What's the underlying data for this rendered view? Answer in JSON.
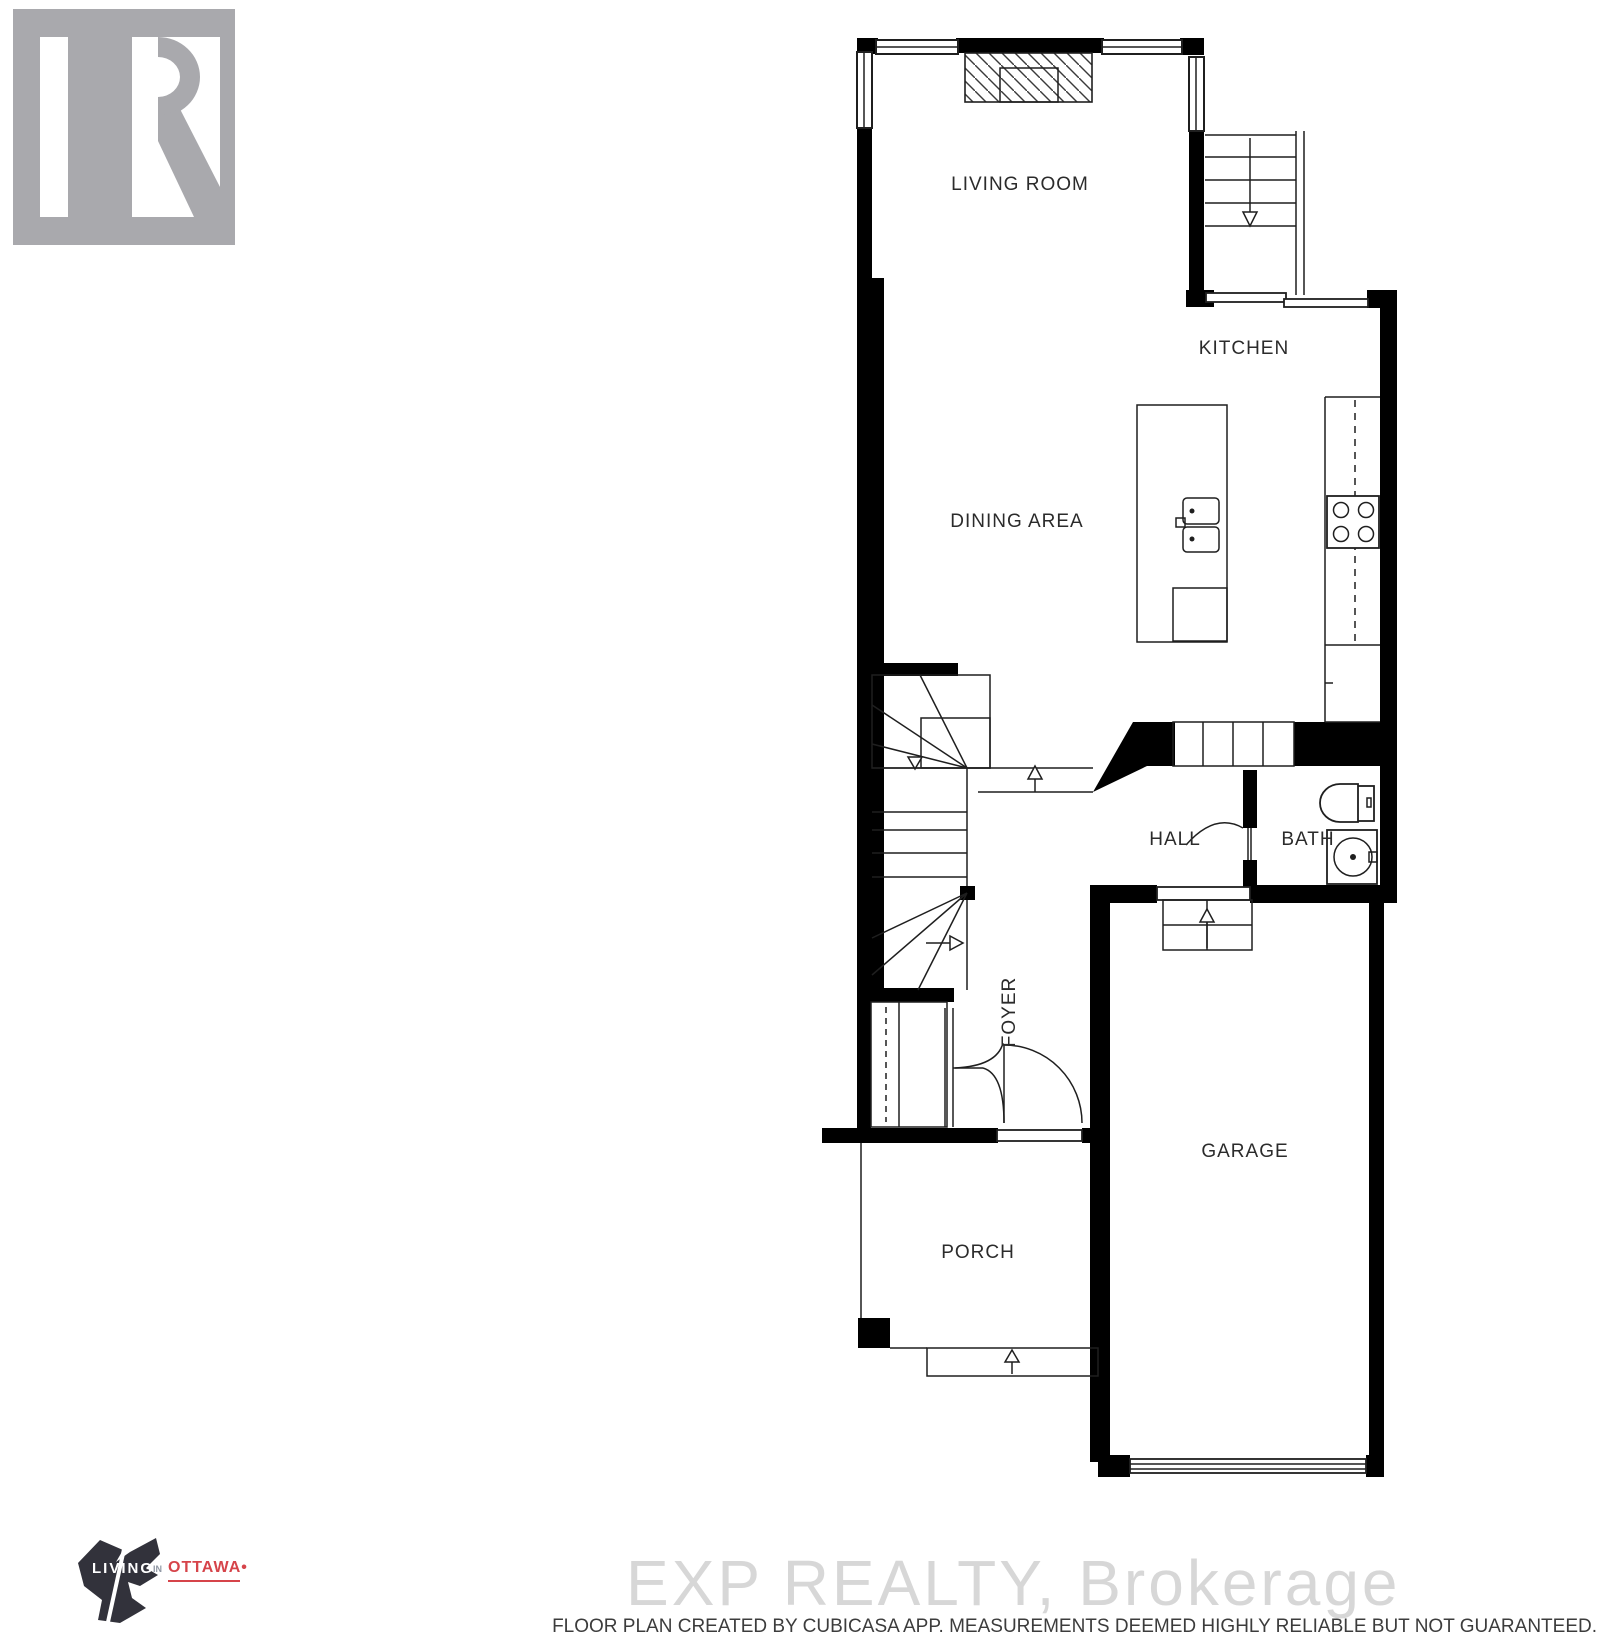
{
  "branding": {
    "realtor": {
      "name": "REALTOR",
      "mark": "®"
    },
    "living_in_ottawa": {
      "word1": "LIVING",
      "word2": "IN",
      "word3": "OTTAWA",
      "bullet": "•"
    }
  },
  "floor_plan": {
    "rooms": [
      {
        "id": "living-room",
        "label": "LIVING ROOM"
      },
      {
        "id": "kitchen",
        "label": "KITCHEN"
      },
      {
        "id": "dining-area",
        "label": "DINING AREA"
      },
      {
        "id": "hall",
        "label": "HALL"
      },
      {
        "id": "bath",
        "label": "BATH"
      },
      {
        "id": "foyer",
        "label": "FOYER"
      },
      {
        "id": "garage",
        "label": "GARAGE"
      },
      {
        "id": "porch",
        "label": "PORCH"
      }
    ]
  },
  "watermark": {
    "text": "EXP REALTY, Brokerage"
  },
  "footer": {
    "disclaimer": "FLOOR PLAN CREATED BY CUBICASA APP. MEASUREMENTS DEEMED HIGHLY RELIABLE BUT NOT GUARANTEED."
  },
  "colors": {
    "paper": "#ffffff",
    "wall": "#000000",
    "line": "#1f1f1f",
    "label": "#2b2b2b",
    "watermark": "#d7d7d7",
    "footer": "#3c3c3c",
    "realtor_gray": "#a9a9ad",
    "ottawa_dark": "#32323b",
    "ottawa_red": "#d6444a"
  }
}
